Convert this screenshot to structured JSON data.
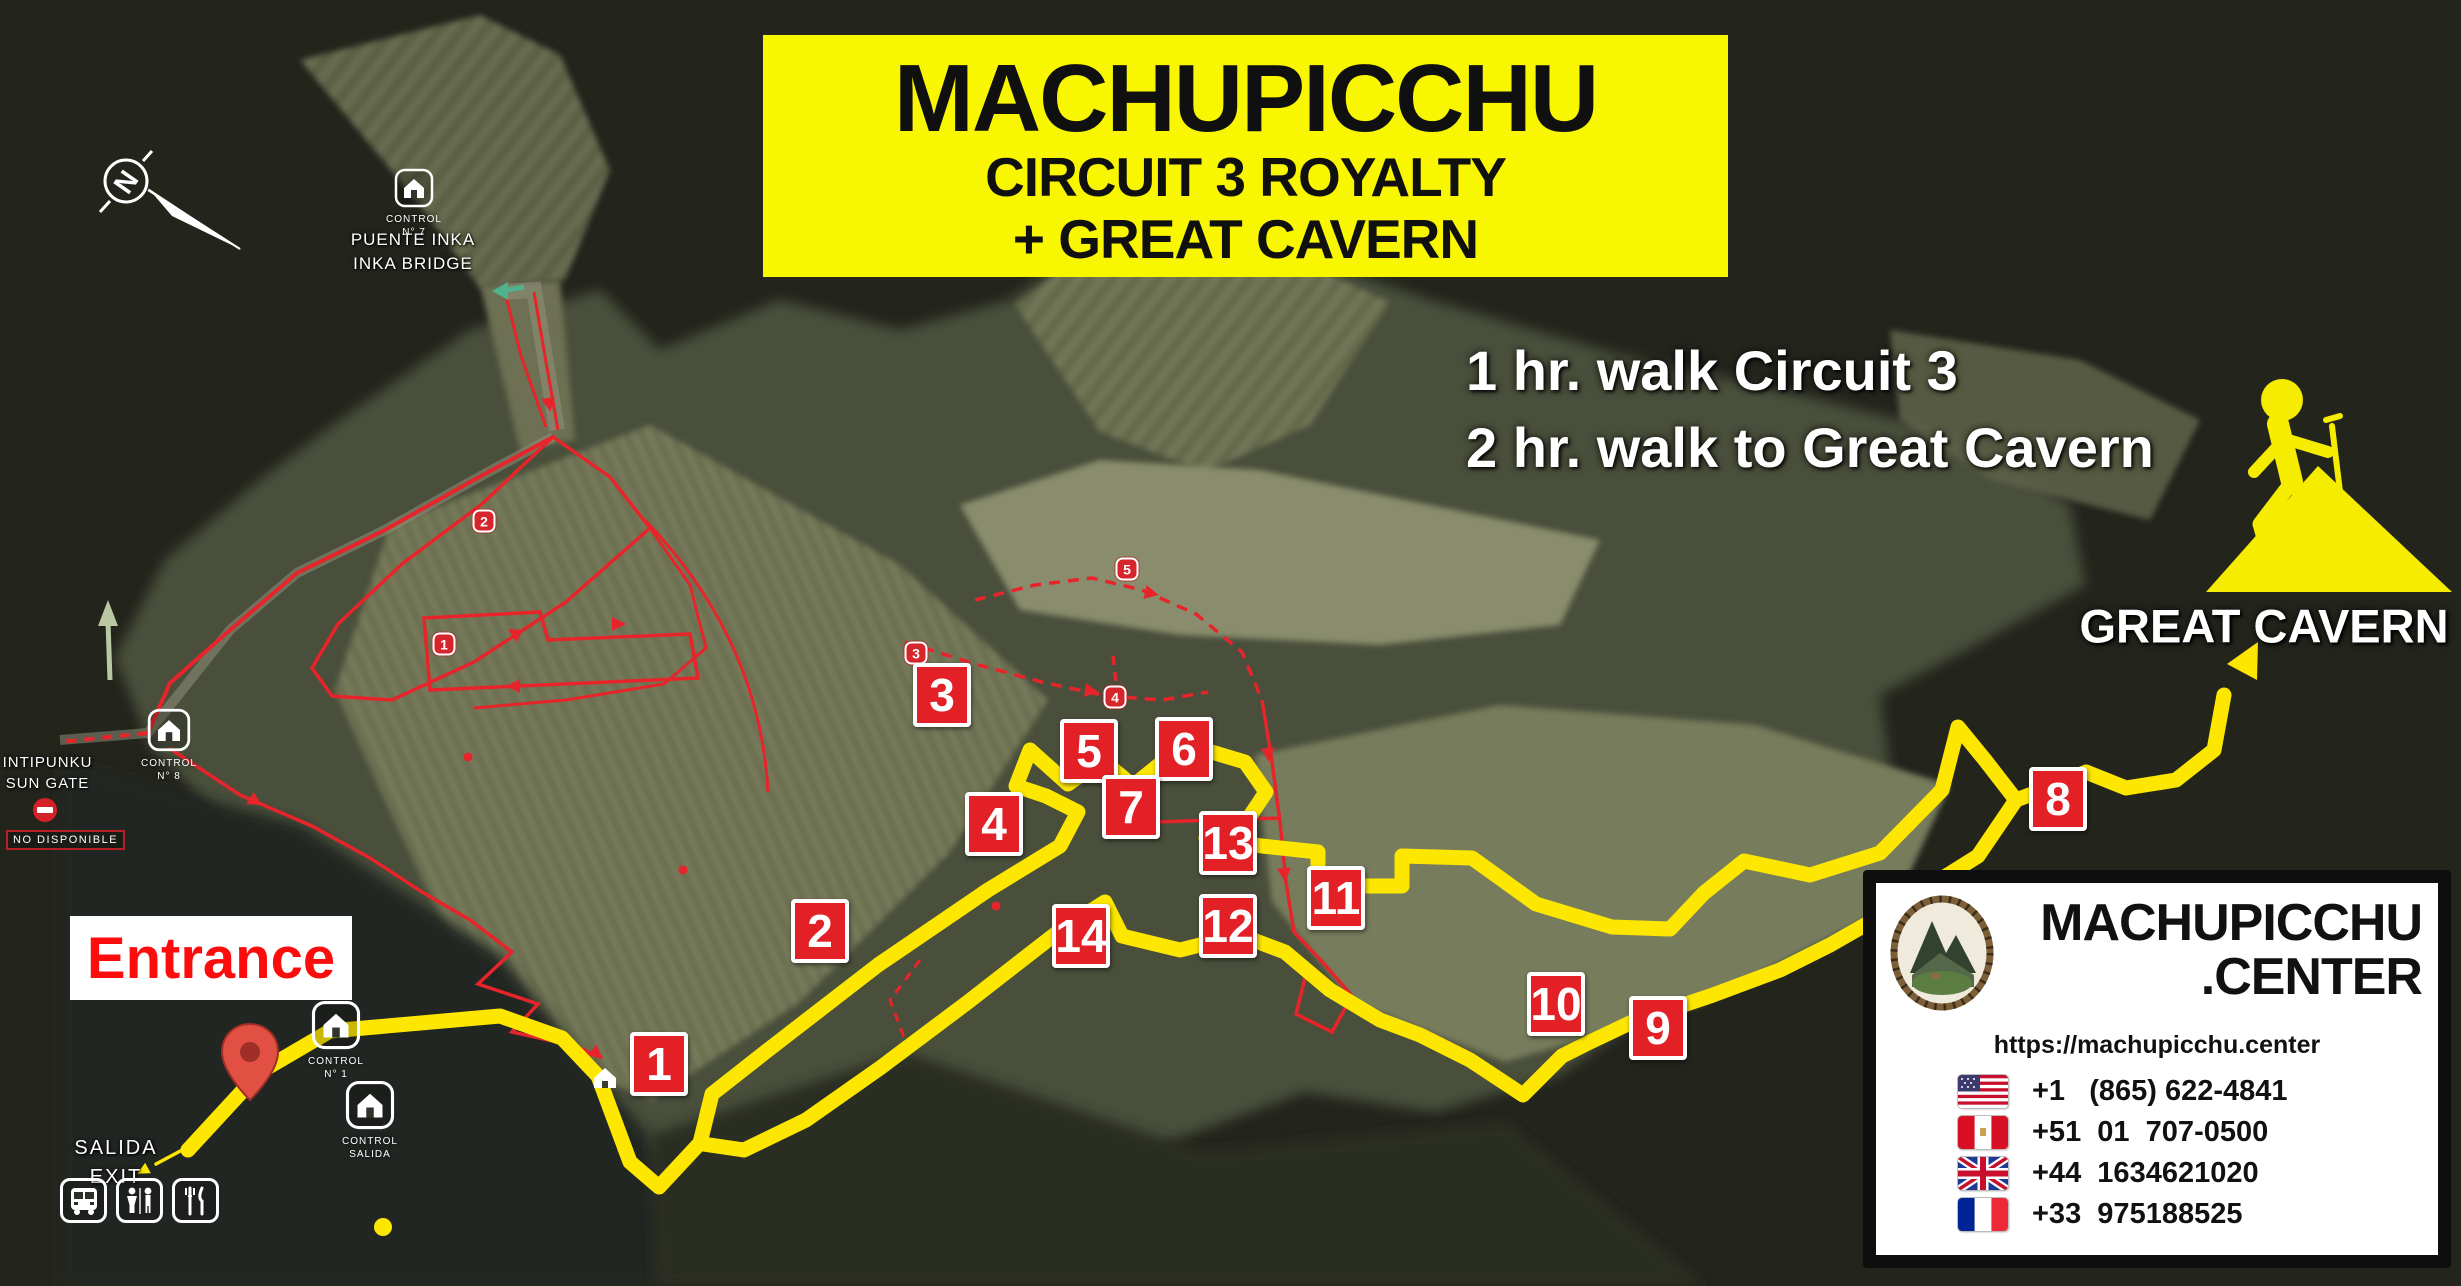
{
  "title": {
    "line1": "MACHUPICCHU",
    "line2": "CIRCUIT 3 ROYALTY",
    "line3": "+ GREAT CAVERN"
  },
  "walk_info": {
    "line1": "1 hr. walk Circuit 3",
    "line2": "2 hr. walk to Great Cavern"
  },
  "great_cavern_label": "GREAT CAVERN",
  "compass": {
    "letter": "N"
  },
  "labels": {
    "entrance": "Entrance",
    "salida_line1": "SALIDA",
    "salida_line2": "EXIT",
    "intipunku_line1": "INTIPUNKU",
    "intipunku_line2": "SUN GATE",
    "no_disponible": "NO DISPONIBLE",
    "puente_line1": "PUENTE INKA",
    "puente_line2": "INKA BRIDGE"
  },
  "controls": {
    "n7": {
      "line1": "CONTROL",
      "line2": "N° 7"
    },
    "n8": {
      "line1": "CONTROL",
      "line2": "N° 8"
    },
    "n1": {
      "line1": "CONTROL",
      "line2": "N° 1"
    },
    "salida": {
      "line1": "CONTROL",
      "line2": "SALIDA"
    }
  },
  "waypoints": [
    {
      "n": "1"
    },
    {
      "n": "2"
    },
    {
      "n": "3"
    },
    {
      "n": "4"
    },
    {
      "n": "5"
    },
    {
      "n": "6"
    },
    {
      "n": "7"
    },
    {
      "n": "8"
    },
    {
      "n": "9"
    },
    {
      "n": "10"
    },
    {
      "n": "11"
    },
    {
      "n": "12"
    },
    {
      "n": "13"
    },
    {
      "n": "14"
    }
  ],
  "badges": [
    {
      "n": "1"
    },
    {
      "n": "2"
    },
    {
      "n": "3"
    },
    {
      "n": "4"
    },
    {
      "n": "5"
    }
  ],
  "contact": {
    "brand_line1": "MACHUPICCHU",
    "brand_line2": ".CENTER",
    "url": "https://machupicchu.center",
    "phones": [
      {
        "country": "usa",
        "number": "+1   (865) 622-4841"
      },
      {
        "country": "peru",
        "number": "+51  01  707-0500"
      },
      {
        "country": "uk",
        "number": "+44  1634621020"
      },
      {
        "country": "france",
        "number": "+33  975188525"
      }
    ]
  },
  "colors": {
    "route_yellow": "#fde700",
    "marker_red": "#e22026",
    "title_yellow": "#f8f600",
    "path_red": "#e8242b"
  }
}
